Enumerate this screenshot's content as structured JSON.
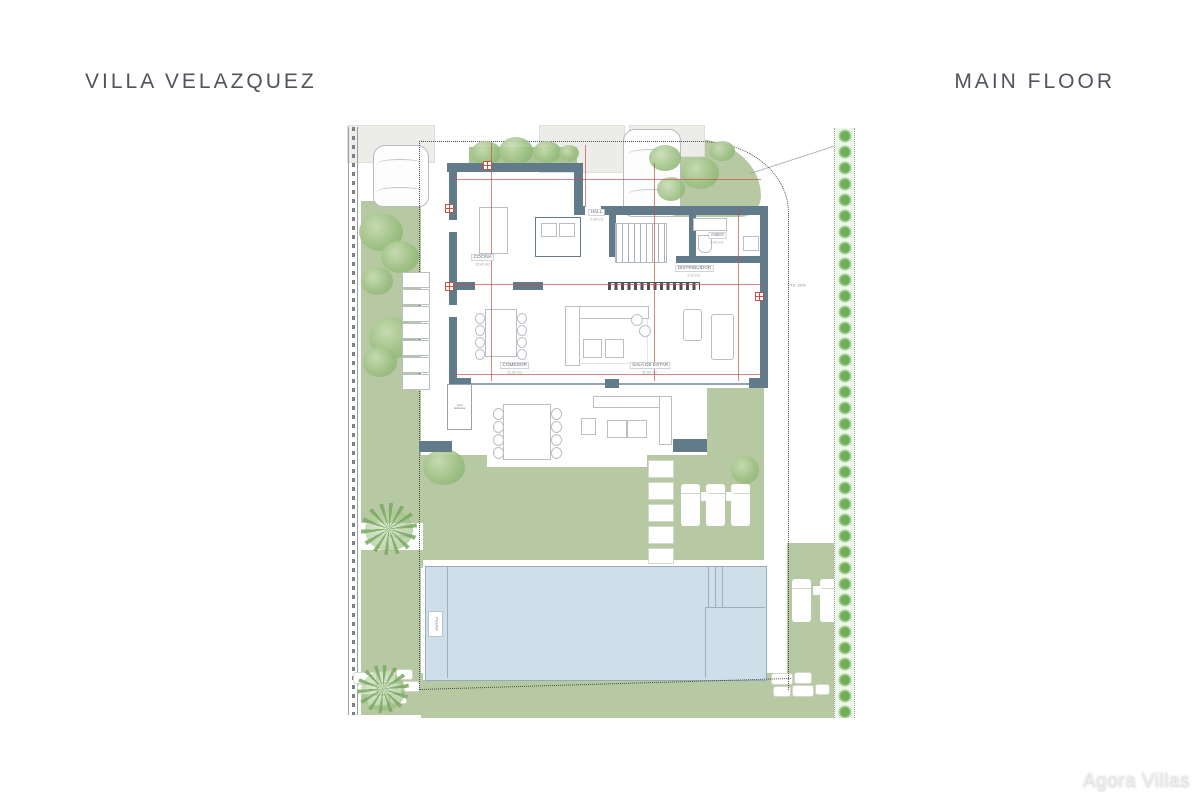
{
  "header": {
    "project_title": "VILLA VELAZQUEZ",
    "floor_title": "MAIN FLOOR"
  },
  "watermark": {
    "text": "Agora Villas"
  },
  "plan": {
    "rooms": [
      {
        "name": "COCINA",
        "area": "15.40 m2"
      },
      {
        "name": "HALL",
        "area": "9.25 m2"
      },
      {
        "name": "ASEO",
        "area": "3.50 m2"
      },
      {
        "name": "DISTRIBUIDOR",
        "area": "5.10 m2"
      },
      {
        "name": "COMEDOR",
        "area": "21.80 m2"
      },
      {
        "name": "SALA DE ESTAR",
        "area": "32.60 m2"
      }
    ],
    "annotations": {
      "slope_label": "PTE. 20%",
      "street_label": "CALLE VELAZQUEZ",
      "pool_label": "PISCINA",
      "bbq_label": "zona barbacoa"
    },
    "colors": {
      "wall": "#617b8a",
      "grass": "#b7c9a2",
      "pool": "#cfdfe9",
      "dimension_line": "#c2524a",
      "boundary": "#45484c",
      "title_text": "#50545b"
    }
  }
}
